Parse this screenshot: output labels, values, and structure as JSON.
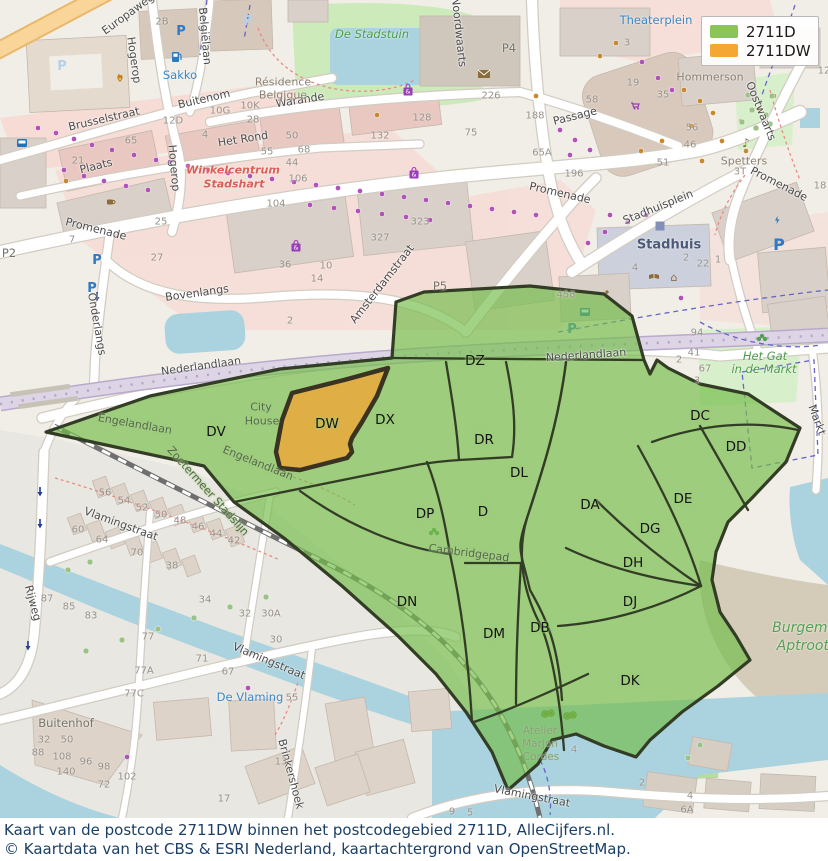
{
  "legend": {
    "items": [
      {
        "label": "2711D",
        "color": "#8cc557"
      },
      {
        "label": "2711DW",
        "color": "#f5a733"
      }
    ]
  },
  "caption": {
    "line1": "Kaart van de postcode 2711DW binnen het postcodegebied 2711D, AlleCijfers.nl.",
    "line2": "© Kaartdata van het CBS & ESRI Nederland, kaartachtergrond van OpenStreetMap."
  },
  "colors": {
    "area_fill": "#74bd4b",
    "area_border": "#333d26",
    "dw_fill": "#f0a738",
    "dw_border": "#3a3322"
  },
  "map": {
    "region_labels": [
      [
        "DZ",
        475,
        361
      ],
      [
        "DV",
        216,
        432
      ],
      [
        "DW",
        327,
        424
      ],
      [
        "DX",
        385,
        420
      ],
      [
        "DR",
        484,
        440
      ],
      [
        "DL",
        519,
        473
      ],
      [
        "DP",
        425,
        514
      ],
      [
        "D",
        483,
        512
      ],
      [
        "DA",
        590,
        505
      ],
      [
        "DN",
        407,
        602
      ],
      [
        "DM",
        494,
        634
      ],
      [
        "DB",
        540,
        628
      ],
      [
        "DC",
        700,
        416
      ],
      [
        "DD",
        736,
        447
      ],
      [
        "DE",
        683,
        499
      ],
      [
        "DG",
        650,
        529
      ],
      [
        "DH",
        633,
        563
      ],
      [
        "DJ",
        630,
        602
      ],
      [
        "DK",
        630,
        681
      ]
    ],
    "streets": [
      [
        "Europaweg",
        128,
        14,
        -36
      ],
      [
        "Hogerop",
        134,
        60,
        82
      ],
      [
        "Hogerop",
        174,
        168,
        85
      ],
      [
        "Belgiëlaan",
        205,
        36,
        85
      ],
      [
        "Brusselstraat",
        104,
        119,
        -13
      ],
      [
        "Buitenom",
        204,
        99,
        -13
      ],
      [
        "Het Rond",
        243,
        139,
        -9
      ],
      [
        "Plaats",
        96,
        166,
        -14
      ],
      [
        "Warande",
        300,
        100,
        -9
      ],
      [
        "Noordwaarts",
        459,
        32,
        84
      ],
      [
        "Passage",
        575,
        116,
        -14
      ],
      [
        "Promenade",
        96,
        229,
        14
      ],
      [
        "Promenade",
        560,
        193,
        13
      ],
      [
        "Promenade",
        779,
        184,
        27
      ],
      [
        "Stadhuisplein",
        658,
        207,
        -22
      ],
      [
        "Oostwaarts",
        761,
        111,
        68
      ],
      [
        "Bovenlangs",
        197,
        293,
        -8
      ],
      [
        "Onderlangs",
        97,
        324,
        80
      ],
      [
        "Nederlandlaan",
        201,
        366,
        -8
      ],
      [
        "Nederlandlaan",
        586,
        355,
        -4
      ],
      [
        "Amsterdamstraat",
        382,
        284,
        -52
      ],
      [
        "Vlamingstraat",
        121,
        524,
        20
      ],
      [
        "Vlamingstraat",
        269,
        661,
        23
      ],
      [
        "Vlamingstraat",
        532,
        796,
        11
      ],
      [
        "Brinkershoek",
        291,
        774,
        75
      ],
      [
        "Rijweg",
        33,
        603,
        75
      ],
      [
        "Markt",
        817,
        420,
        70
      ]
    ],
    "streets_under": [
      [
        "Engelandlaan",
        135,
        424,
        10
      ],
      [
        "Engelandlaan",
        258,
        463,
        22
      ],
      [
        "Cambridgepad",
        469,
        553,
        7
      ],
      [
        "Zoetermeer Stadslijn",
        208,
        491,
        48
      ],
      [
        "City",
        261,
        407,
        0
      ],
      [
        "House",
        262,
        421,
        0
      ]
    ],
    "places": [
      [
        "Theaterplein",
        656,
        20,
        "blue"
      ],
      [
        "Sakko",
        180,
        75,
        "blue"
      ],
      [
        "De Vlaming",
        250,
        697,
        "blue"
      ],
      [
        "Stadhuis",
        669,
        245,
        "boldblue"
      ],
      [
        "Winkelcentrum",
        233,
        170,
        "red"
      ],
      [
        "Stadshart",
        234,
        184,
        "red"
      ],
      [
        "De Stadstuin",
        372,
        34,
        "green"
      ],
      [
        "Het Gat",
        765,
        356,
        "green"
      ],
      [
        "in de Markt",
        764,
        369,
        "green"
      ],
      [
        "Burgemeester",
        822,
        628,
        "greenbig"
      ],
      [
        "Aptroothof",
        814,
        646,
        "greenbig"
      ],
      [
        "Hommerson",
        710,
        77,
        "grey"
      ],
      [
        "Spetters",
        744,
        161,
        "grey"
      ],
      [
        "Résidence",
        283,
        82,
        "grey"
      ],
      [
        "Belgique",
        283,
        95,
        "grey"
      ],
      [
        "Buitenhof",
        66,
        723,
        "grey2"
      ],
      [
        "P2",
        9,
        253,
        "grey2"
      ],
      [
        "P4",
        509,
        48,
        "grey2"
      ],
      [
        "P5",
        440,
        286,
        "grey2"
      ],
      [
        "Atelier",
        540,
        731,
        "faint"
      ],
      [
        "Marjon",
        540,
        744,
        "faint"
      ],
      [
        "Cordes",
        541,
        757,
        "faint"
      ]
    ],
    "house_numbers": [
      [
        "2B",
        162,
        22
      ],
      [
        "10G",
        220,
        111
      ],
      [
        "10K",
        250,
        106
      ],
      [
        "28",
        253,
        120
      ],
      [
        "12D",
        173,
        121
      ],
      [
        "65",
        131,
        141
      ],
      [
        "21",
        78,
        161
      ],
      [
        "4",
        205,
        135
      ],
      [
        "55",
        267,
        152
      ],
      [
        "25",
        161,
        222
      ],
      [
        "27",
        157,
        258
      ],
      [
        "7",
        72,
        240
      ],
      [
        "106",
        298,
        179
      ],
      [
        "44",
        292,
        163
      ],
      [
        "68",
        304,
        150
      ],
      [
        "50",
        292,
        136
      ],
      [
        "132",
        380,
        136
      ],
      [
        "128",
        422,
        118
      ],
      [
        "104",
        276,
        204
      ],
      [
        "36",
        285,
        265
      ],
      [
        "10",
        326,
        266
      ],
      [
        "14",
        317,
        279
      ],
      [
        "2",
        290,
        321
      ],
      [
        "226",
        491,
        96
      ],
      [
        "75",
        471,
        133
      ],
      [
        "188",
        535,
        116
      ],
      [
        "65A",
        542,
        153
      ],
      [
        "323",
        420,
        222
      ],
      [
        "327",
        380,
        238
      ],
      [
        "3",
        627,
        43
      ],
      [
        "19",
        633,
        83
      ],
      [
        "35",
        663,
        95
      ],
      [
        "58",
        592,
        100
      ],
      [
        "56",
        692,
        128
      ],
      [
        "46",
        690,
        145
      ],
      [
        "51",
        663,
        163
      ],
      [
        "196",
        574,
        174
      ],
      [
        "3T",
        740,
        172
      ],
      [
        "12",
        824,
        71
      ],
      [
        "18",
        820,
        186
      ],
      [
        "458",
        566,
        295
      ],
      [
        "4",
        635,
        268
      ],
      [
        "2",
        686,
        258
      ],
      [
        "22",
        703,
        264
      ],
      [
        "1",
        718,
        260
      ],
      [
        "94",
        697,
        333
      ],
      [
        "41",
        694,
        353
      ],
      [
        "2",
        679,
        360
      ],
      [
        "67",
        705,
        369
      ],
      [
        "3",
        697,
        381
      ],
      [
        "56",
        105,
        493
      ],
      [
        "54",
        124,
        501
      ],
      [
        "52",
        142,
        508
      ],
      [
        "50",
        161,
        515
      ],
      [
        "48",
        180,
        521
      ],
      [
        "46",
        198,
        527
      ],
      [
        "44",
        216,
        534
      ],
      [
        "42",
        234,
        541
      ],
      [
        "60",
        78,
        530
      ],
      [
        "64",
        102,
        540
      ],
      [
        "70",
        137,
        553
      ],
      [
        "38",
        172,
        566
      ],
      [
        "34",
        205,
        600
      ],
      [
        "32",
        245,
        614
      ],
      [
        "30A",
        271,
        614
      ],
      [
        "30",
        276,
        640
      ],
      [
        "87",
        47,
        599
      ],
      [
        "85",
        69,
        607
      ],
      [
        "83",
        91,
        616
      ],
      [
        "77",
        148,
        637
      ],
      [
        "71",
        202,
        659
      ],
      [
        "67",
        228,
        672
      ],
      [
        "77A",
        144,
        671
      ],
      [
        "77C",
        134,
        694
      ],
      [
        "55",
        292,
        698
      ],
      [
        "13",
        281,
        762
      ],
      [
        "32",
        44,
        740
      ],
      [
        "50",
        67,
        740
      ],
      [
        "88",
        38,
        753
      ],
      [
        "108",
        62,
        757
      ],
      [
        "96",
        86,
        762
      ],
      [
        "98",
        104,
        767
      ],
      [
        "140",
        66,
        772
      ],
      [
        "102",
        127,
        777
      ],
      [
        "72",
        104,
        785
      ],
      [
        "4",
        574,
        750
      ],
      [
        "2",
        642,
        783
      ],
      [
        "6A",
        687,
        810
      ],
      [
        "4",
        690,
        796
      ],
      [
        "9",
        452,
        812
      ],
      [
        "5",
        470,
        813
      ],
      [
        "17",
        224,
        799
      ]
    ],
    "icons": [
      [
        "parking",
        181,
        31
      ],
      [
        "parking",
        97,
        260
      ],
      [
        "parking",
        92,
        288
      ],
      [
        "parking",
        572,
        329
      ],
      [
        "parking-lg",
        779,
        246
      ],
      [
        "parking-pale",
        62,
        66
      ],
      [
        "parking-pale",
        248,
        21
      ],
      [
        "fuel",
        176,
        57
      ],
      [
        "flame",
        120,
        77
      ],
      [
        "mail",
        484,
        74
      ],
      [
        "cart",
        635,
        106
      ],
      [
        "bag",
        414,
        174
      ],
      [
        "bag",
        296,
        247
      ],
      [
        "bag",
        408,
        91
      ],
      [
        "note",
        746,
        143
      ],
      [
        "book",
        654,
        277
      ],
      [
        "museum",
        674,
        277
      ],
      [
        "person",
        607,
        295
      ],
      [
        "cup",
        110,
        202
      ],
      [
        "bolt",
        777,
        220
      ],
      [
        "square",
        660,
        226
      ],
      [
        "bus",
        585,
        312
      ],
      [
        "bus",
        22,
        143
      ],
      [
        "trees",
        548,
        714
      ],
      [
        "trees",
        570,
        716
      ],
      [
        "park",
        762,
        338
      ],
      [
        "park",
        434,
        532
      ]
    ],
    "dots": {
      "shops": [
        [
          38,
          128
        ],
        [
          56,
          133
        ],
        [
          74,
          139
        ],
        [
          92,
          145
        ],
        [
          112,
          150
        ],
        [
          134,
          155
        ],
        [
          156,
          160
        ],
        [
          64,
          170
        ],
        [
          84,
          176
        ],
        [
          104,
          181
        ],
        [
          126,
          186
        ],
        [
          148,
          190
        ],
        [
          170,
          162
        ],
        [
          188,
          166
        ],
        [
          208,
          170
        ],
        [
          228,
          173
        ],
        [
          250,
          176
        ],
        [
          272,
          179
        ],
        [
          294,
          182
        ],
        [
          316,
          185
        ],
        [
          338,
          188
        ],
        [
          360,
          191
        ],
        [
          382,
          194
        ],
        [
          404,
          197
        ],
        [
          426,
          200
        ],
        [
          448,
          203
        ],
        [
          470,
          206
        ],
        [
          492,
          209
        ],
        [
          514,
          212
        ],
        [
          536,
          215
        ],
        [
          310,
          205
        ],
        [
          334,
          208
        ],
        [
          358,
          211
        ],
        [
          382,
          214
        ],
        [
          406,
          217
        ],
        [
          430,
          220
        ],
        [
          560,
          130
        ],
        [
          575,
          140
        ],
        [
          590,
          150
        ],
        [
          570,
          155
        ],
        [
          610,
          215
        ],
        [
          628,
          222
        ],
        [
          646,
          215
        ],
        [
          605,
          232
        ],
        [
          588,
          243
        ],
        [
          642,
          62
        ],
        [
          658,
          78
        ],
        [
          672,
          90
        ],
        [
          681,
          298
        ],
        [
          127,
          757
        ],
        [
          248,
          688
        ]
      ],
      "amenities": [
        [
          684,
          90
        ],
        [
          700,
          101
        ],
        [
          713,
          113
        ],
        [
          691,
          126
        ],
        [
          662,
          141
        ],
        [
          641,
          151
        ],
        [
          741,
          121
        ],
        [
          759,
          109
        ],
        [
          774,
          96
        ],
        [
          722,
          141
        ],
        [
          746,
          151
        ],
        [
          702,
          161
        ],
        [
          616,
          43
        ],
        [
          600,
          56
        ],
        [
          66,
          181
        ],
        [
          377,
          115
        ],
        [
          536,
          96
        ]
      ],
      "trees": [
        [
          748,
          95
        ],
        [
          760,
          102
        ],
        [
          772,
          96
        ],
        [
          752,
          110
        ],
        [
          766,
          115
        ],
        [
          742,
          122
        ],
        [
          756,
          128
        ],
        [
          770,
          124
        ],
        [
          86,
          651
        ],
        [
          122,
          640
        ],
        [
          158,
          629
        ],
        [
          194,
          618
        ],
        [
          230,
          607
        ],
        [
          266,
          597
        ],
        [
          68,
          570
        ],
        [
          90,
          562
        ],
        [
          700,
          745
        ],
        [
          688,
          758
        ]
      ]
    },
    "arrows": [
      [
        40,
        492
      ],
      [
        40,
        524
      ],
      [
        28,
        646
      ],
      [
        97,
        297
      ]
    ]
  }
}
